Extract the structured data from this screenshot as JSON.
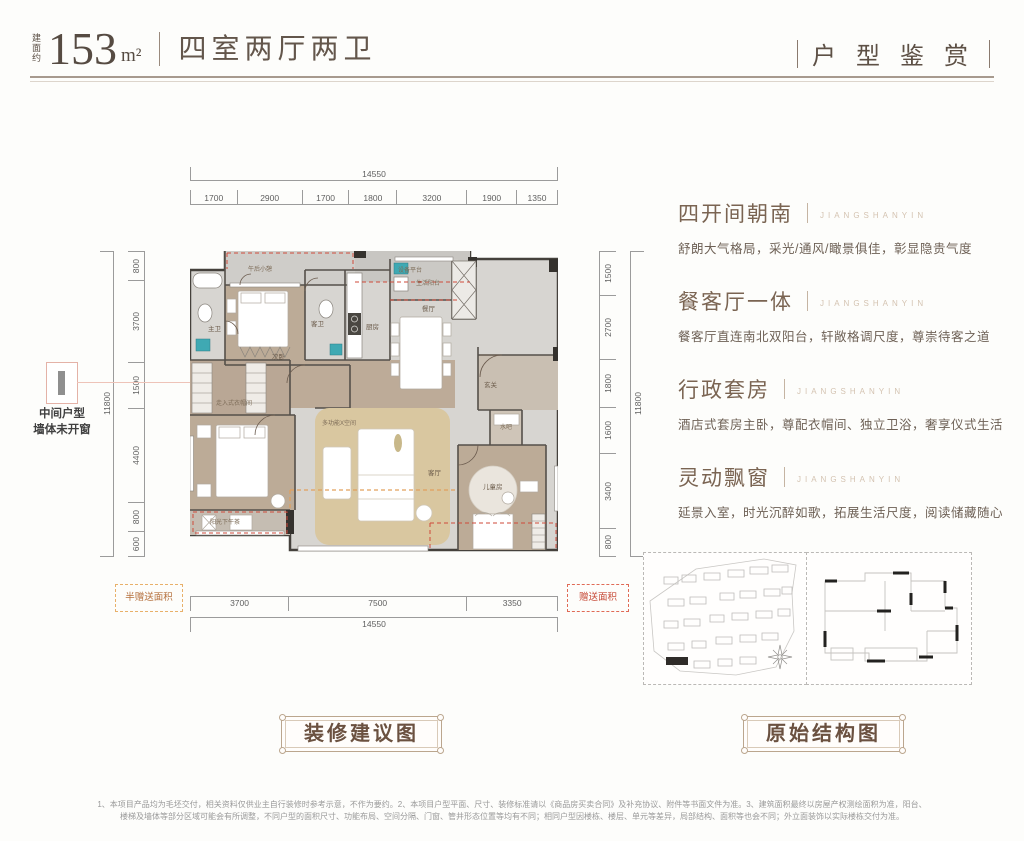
{
  "header": {
    "area_prefix": "建面约",
    "area_value": "153",
    "area_unit": "m²",
    "rooms_title": "四室两厅两卫",
    "series_title": "户 型 鉴 赏"
  },
  "side_note": {
    "line1": "中间户型",
    "line2": "墙体未开窗"
  },
  "features": [
    {
      "title": "四开间朝南",
      "watermark": "JIANGSHANYIN",
      "desc": "舒朗大气格局，采光/通风/瞰景俱佳，彰显隐贵气度"
    },
    {
      "title": "餐客厅一体",
      "watermark": "JIANGSHANYIN",
      "desc": "餐客厅直连南北双阳台，轩敞格调尺度，尊崇待客之道"
    },
    {
      "title": "行政套房",
      "watermark": "JIANGSHANYIN",
      "desc": "酒店式套房主卧，尊配衣帽间、独立卫浴，奢享仪式生活"
    },
    {
      "title": "灵动飘窗",
      "watermark": "JIANGSHANYIN",
      "desc": "延景入室，时光沉醉如歌，拓展生活尺度，阅读储藏随心"
    }
  ],
  "plan": {
    "dims": {
      "top_total": "14550",
      "top": [
        "1700",
        "2900",
        "1700",
        "1800",
        "3200",
        "1900",
        "1350"
      ],
      "bottom": [
        "3700",
        "7500",
        "3350"
      ],
      "bottom_total": "14550",
      "left": [
        "800",
        "3700",
        "1500",
        "4400",
        "800",
        "600"
      ],
      "left_total": "11800",
      "right": [
        "1500",
        "2700",
        "1800",
        "1600",
        "3400",
        "800"
      ],
      "right_total": "11800"
    },
    "rooms": {
      "balcony_north_left": "午后小憩",
      "equipment_platform": "设备平台",
      "bedroom2": "次卧",
      "master_bath": "主卫",
      "guest_bath": "客卫",
      "kitchen": "厨房",
      "balcony_life": "生活阳台",
      "dining": "餐厅",
      "foyer": "玄关",
      "living": "客厅",
      "flex_space": "多功能X空间",
      "walkin_closet": "走入式衣帽间",
      "balcony_south": "阳光下午茶",
      "kids_room": "儿童房",
      "water_bar": "水吧"
    },
    "gift_half": "半赠送面积",
    "gift_full": "赠送面积"
  },
  "captions": {
    "decor": "装修建议图",
    "original": "原始结构图"
  },
  "colors": {
    "accent_teal": "#3fa9b3",
    "gift_red": "#cf4a3a",
    "gift_orange": "#e2a05c",
    "title_brown": "#7a6452",
    "wood_floor": "#b9a795",
    "flex_tan": "#d9c7a0"
  },
  "footnote": {
    "line1": "1、本项目产品均为毛坯交付，相关资料仅供业主自行装修时参考示意，不作为要约。2、本项目户型平面、尺寸、装修标准请以《商品房买卖合同》及补充协议、附件等书面文件为准。3、建筑面积最终以房屋产权测绘面积为准，阳台、",
    "line2": "楼梯及墙体等部分区域可能会有所调整，不同户型的面积尺寸、功能布局、空间分隔、门窗、管井形态位置等均有不同；相同户型因楼栋、楼层、单元等差异，局部结构、面积等也会不同；外立面装饰以实际楼栋交付为准。"
  }
}
